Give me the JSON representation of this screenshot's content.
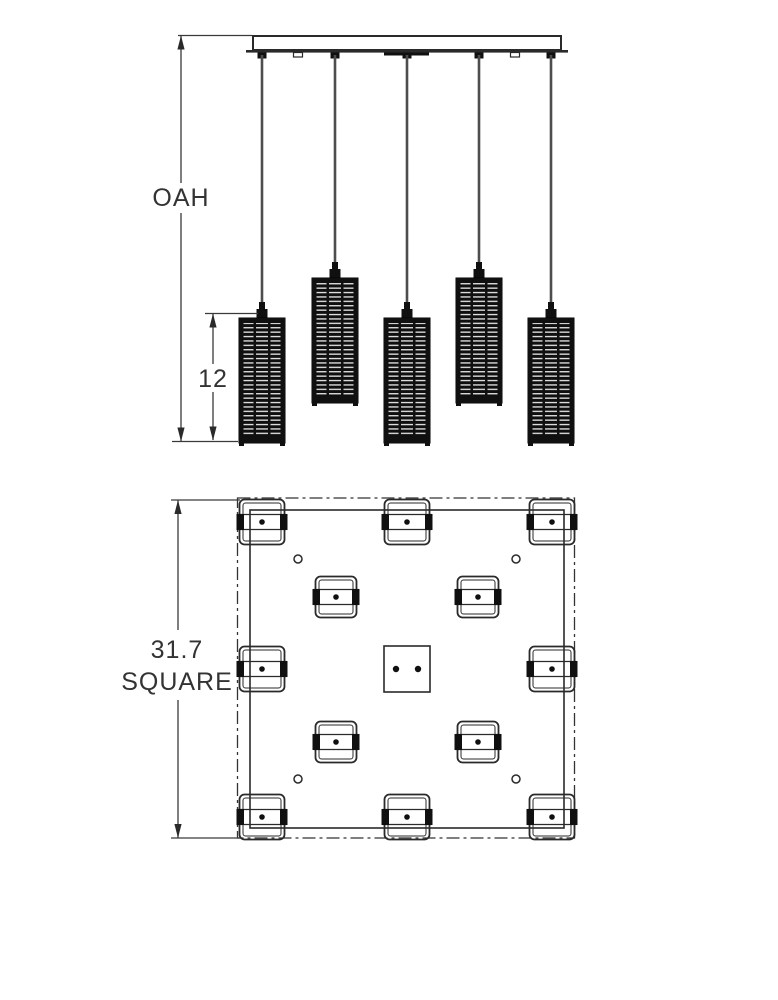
{
  "page": {
    "background": "#ffffff"
  },
  "drawing": {
    "type": "pendant-chandelier-dimension-diagram",
    "views": {
      "elevation": {
        "name": "side-elevation",
        "overall_height_label": "OAH",
        "shade_height_label": "12",
        "pendant_count": 5,
        "canopy": {
          "x": 253,
          "y": 36,
          "width": 308,
          "height": 14
        },
        "canopy_hooks_x": [
          298,
          515
        ],
        "canopy_center_plate": {
          "x": 384,
          "y": 52.5,
          "width": 45,
          "height": 3
        },
        "pendants": [
          {
            "cord_x": 262,
            "shade_top": 318
          },
          {
            "cord_x": 335,
            "shade_top": 278
          },
          {
            "cord_x": 407,
            "shade_top": 318
          },
          {
            "cord_x": 479,
            "shade_top": 278
          },
          {
            "cord_x": 551,
            "shade_top": 318
          }
        ],
        "shade": {
          "width": 46,
          "height": 125
        }
      },
      "plan": {
        "name": "canopy-plan-view",
        "dimension_label_line1": "31.7",
        "dimension_label_line2": "SQUARE",
        "pendant_count": 12,
        "outer_square": {
          "x": 237.5,
          "y": 498,
          "width": 337,
          "height": 340
        },
        "inner_square": {
          "x": 250,
          "y": 510,
          "width": 314,
          "height": 318
        },
        "perimeter_symbol_size": 45,
        "inner_symbol_size": 41,
        "perimeter_pendants": [
          [
            262,
            522
          ],
          [
            407,
            522
          ],
          [
            552,
            522
          ],
          [
            262,
            669
          ],
          [
            552,
            669
          ],
          [
            262,
            817
          ],
          [
            407,
            817
          ],
          [
            552,
            817
          ]
        ],
        "inner_pendants": [
          [
            336,
            597
          ],
          [
            478,
            597
          ],
          [
            336,
            742
          ],
          [
            478,
            742
          ]
        ],
        "screw_holes": [
          [
            298,
            559
          ],
          [
            516,
            559
          ],
          [
            298,
            779
          ],
          [
            516,
            779
          ]
        ],
        "center_box": {
          "x": 384,
          "y": 646,
          "size": 46,
          "dots": [
            [
              396,
              669
            ],
            [
              418,
              669
            ]
          ]
        }
      }
    },
    "colors": {
      "line": "#2a2a2a",
      "dim_line": "#3a3a3a",
      "dark": "#101010",
      "cord": "#4d4d4d",
      "slat_light": "#e9e9e9",
      "text": "#333333",
      "background": "#ffffff"
    }
  }
}
